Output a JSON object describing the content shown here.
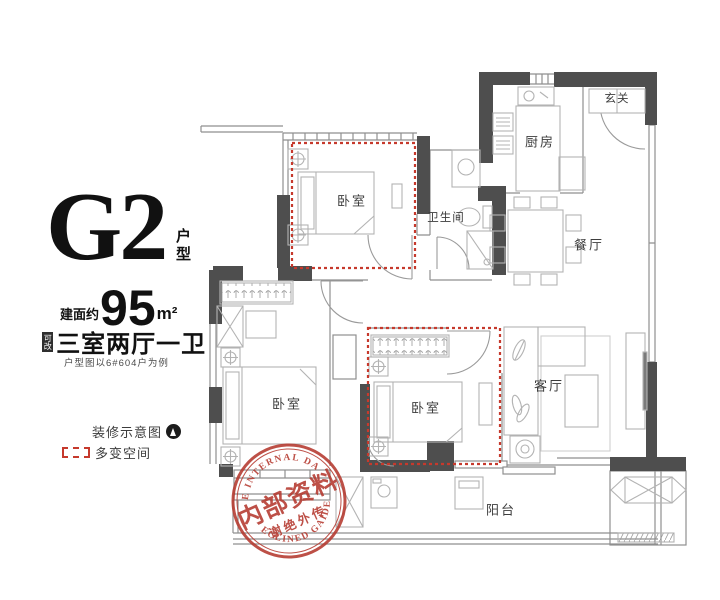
{
  "info_panel": {
    "unit_code": "G2",
    "unit_type_label": "户型",
    "area_prefix": "建面约",
    "area_value": "95",
    "area_unit": "m²",
    "layout_badge": "可改",
    "layout_text": "三室两厅一卫",
    "note": "户型图以6#604户为例",
    "legend": [
      {
        "icon": "north-compass-icon",
        "label": "装修示意图"
      },
      {
        "icon": "red-dashed-box-icon",
        "label": "多变空间"
      }
    ]
  },
  "floor_plan": {
    "rooms": [
      {
        "id": "entry",
        "label": "玄关"
      },
      {
        "id": "kitchen",
        "label": "厨房"
      },
      {
        "id": "dining",
        "label": "餐厅"
      },
      {
        "id": "bathroom",
        "label": "卫生间"
      },
      {
        "id": "bedroom-1",
        "label": "卧室"
      },
      {
        "id": "bedroom-2",
        "label": "卧室"
      },
      {
        "id": "bedroom-3",
        "label": "卧室"
      },
      {
        "id": "living",
        "label": "客厅"
      },
      {
        "id": "balcony",
        "label": "阳台"
      }
    ]
  },
  "stamp": {
    "arc_top": "THE INTERNAL DATA",
    "arc_bottom": "DECLINED GAIDEN",
    "line1": "内部资料",
    "line2": "谢绝外传"
  },
  "colors": {
    "wall": "#4e4e4e",
    "thin_line": "#8f8f8f",
    "furniture": "#b3b3b3",
    "accent_red": "#c6392c",
    "stamp_red": "#b5382e"
  }
}
